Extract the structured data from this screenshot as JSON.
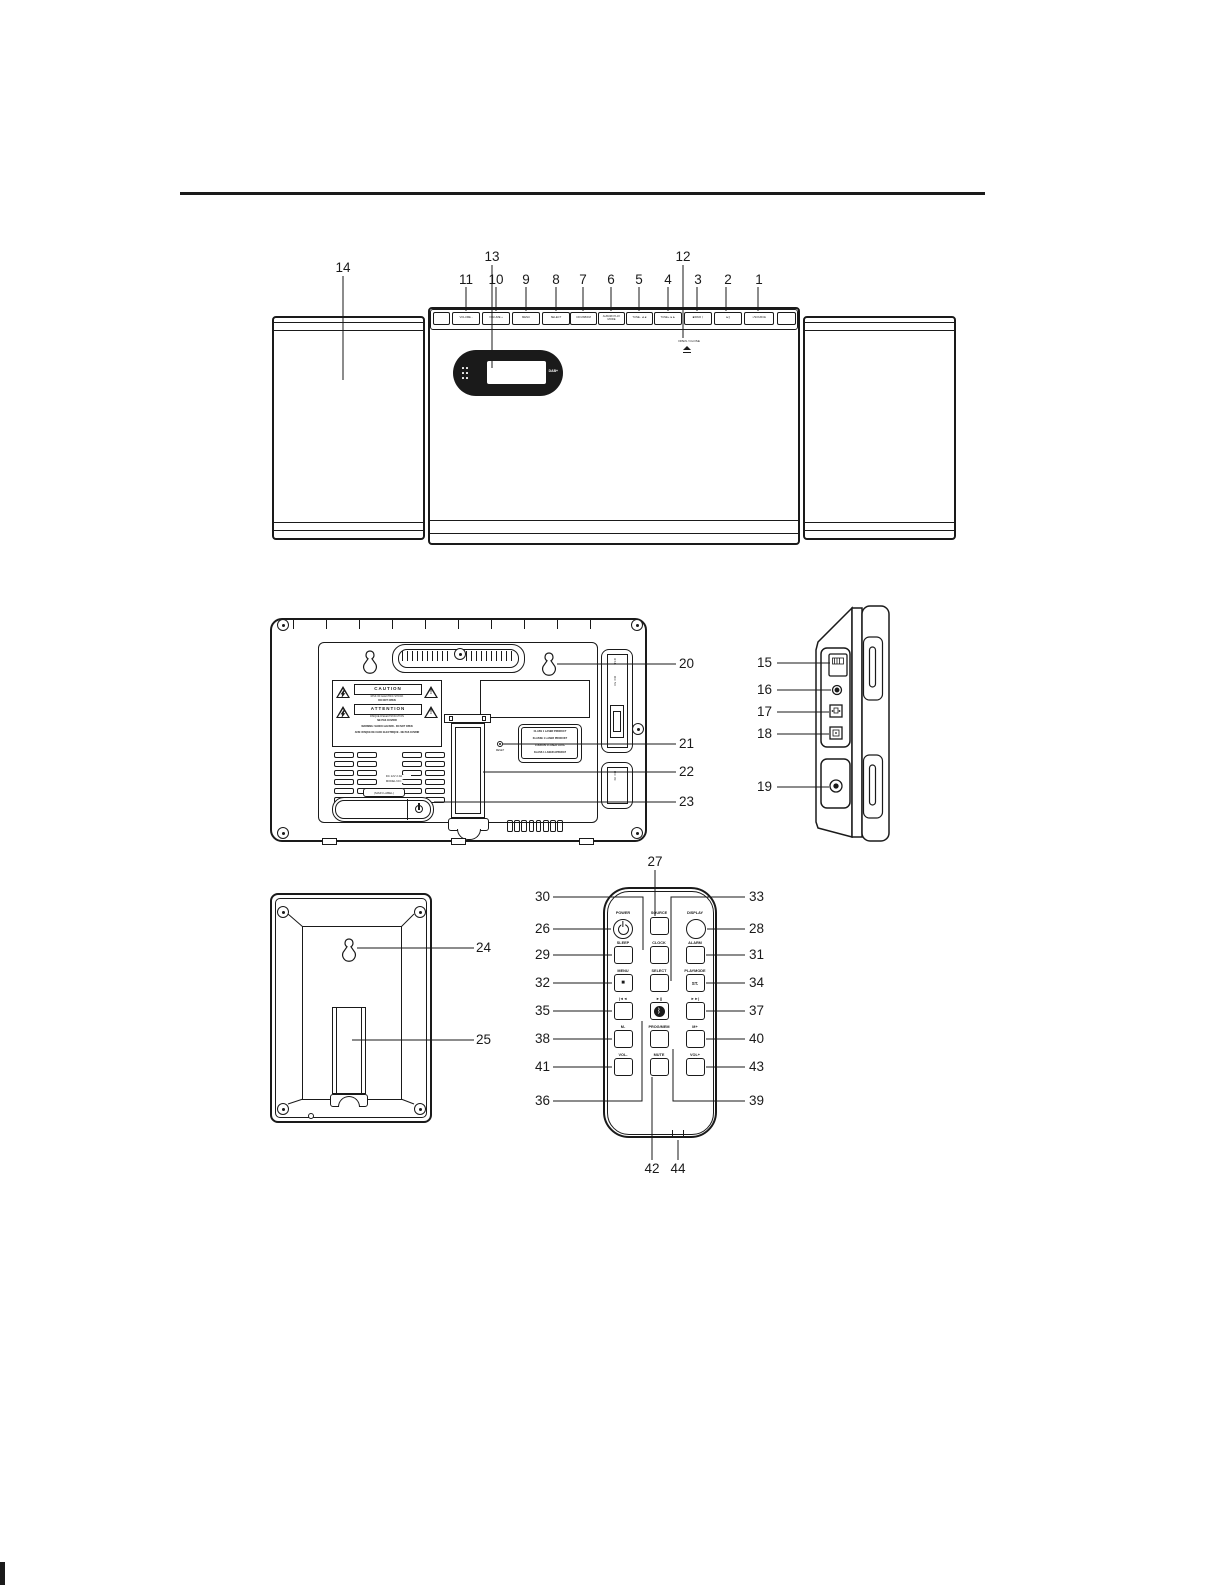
{
  "front_view": {
    "speaker_callout": "14",
    "display_callout": "13",
    "open_close_callout": "12",
    "display": {
      "logo": "DAB+"
    },
    "open_close": {
      "line1": "OPEN / CLOSE"
    },
    "top_buttons": [
      {
        "num": "11",
        "label": "VOLUME -"
      },
      {
        "num": "10",
        "label": "VOLUME +"
      },
      {
        "num": "9",
        "label": "MENU"
      },
      {
        "num": "8",
        "label": "SELECT"
      },
      {
        "num": "7",
        "label": "CD/USB/FM"
      },
      {
        "num": "6",
        "label": "ALBUM/ PLAY MODE"
      },
      {
        "num": "5",
        "label": "TUNE- ◄◄"
      },
      {
        "num": "4",
        "label": "TUNE+ ►►"
      },
      {
        "num": "3",
        "label": "■/PAIR ᛒ"
      },
      {
        "num": "2",
        "label": "►||"
      },
      {
        "num": "1",
        "label": "○/SOURCE"
      }
    ]
  },
  "back_view": {
    "callouts": {
      "c20": "20",
      "c21": "21",
      "c22": "22",
      "c23": "23"
    },
    "caution": {
      "title1": "CAUTION",
      "line1a": "RISK OF ELECTRIC SHOCK",
      "line1b": "DO NOT OPEN",
      "title2": "ATTENTION",
      "line2a": "RISQUE D'ELECTROCUTION",
      "line2b": "NE PAS OUVRIR",
      "line3": "WARNING: SHOCK HAZARD - DO NOT OPEN",
      "line4": "AVIS: RISQUE DE CHOC ELECTRIQUE - NE PAS OUVRIR"
    },
    "laser": {
      "line1": "CLASS 1 LASER PRODUCT",
      "line2": "KLASSE 1 LASER PRODUKT",
      "line3": "LUOKAN 1 LASER LAITE",
      "line4": "KLASS 1 LASER APPARAT"
    },
    "rating": {
      "line1": "DC 12V 2.0A",
      "line2": "MODEL NO.:",
      "box": "(MAIN LABEL)"
    },
    "reset": "RESET",
    "ports": {
      "usb": "USB",
      "dc5v": "DC 5V",
      "dcin": "DC IN"
    }
  },
  "side_view": {
    "callouts": {
      "c15": "15",
      "c16": "16",
      "c17": "17",
      "c18": "18",
      "c19": "19"
    }
  },
  "speaker_rear": {
    "callouts": {
      "c24": "24",
      "c25": "25"
    }
  },
  "remote": {
    "bottom_callouts": {
      "c44": "44"
    },
    "buttons": {
      "power": {
        "label": "POWER",
        "num": "26"
      },
      "source": {
        "label": "SOURCE",
        "num": "27"
      },
      "display": {
        "label": "DISPLAY",
        "num": "28"
      },
      "sleep": {
        "label": "SLEEP",
        "num": "29"
      },
      "clock": {
        "label": "CLOCK",
        "num": "30"
      },
      "alarm": {
        "label": "ALARM",
        "num": "31"
      },
      "menu": {
        "label": "MENU",
        "num": "32",
        "face": "■"
      },
      "select": {
        "label": "SELECT",
        "num": "33"
      },
      "playmode": {
        "label": "PLAYMODE",
        "num": "34",
        "face": "ST."
      },
      "prev": {
        "label": "|◄◄",
        "num": "35"
      },
      "playpause": {
        "label": "►||",
        "num": "36",
        "face": "ᛒ"
      },
      "next": {
        "label": "►►|",
        "num": "37"
      },
      "m_minus": {
        "label": "M-",
        "num": "38"
      },
      "progmem": {
        "label": "PROG/MEM",
        "num": "39"
      },
      "m_plus": {
        "label": "M+",
        "num": "40"
      },
      "vol_minus": {
        "label": "VOL-",
        "num": "41"
      },
      "mute": {
        "label": "MUTE",
        "num": "42"
      },
      "vol_plus": {
        "label": "VOL+",
        "num": "43"
      }
    }
  }
}
